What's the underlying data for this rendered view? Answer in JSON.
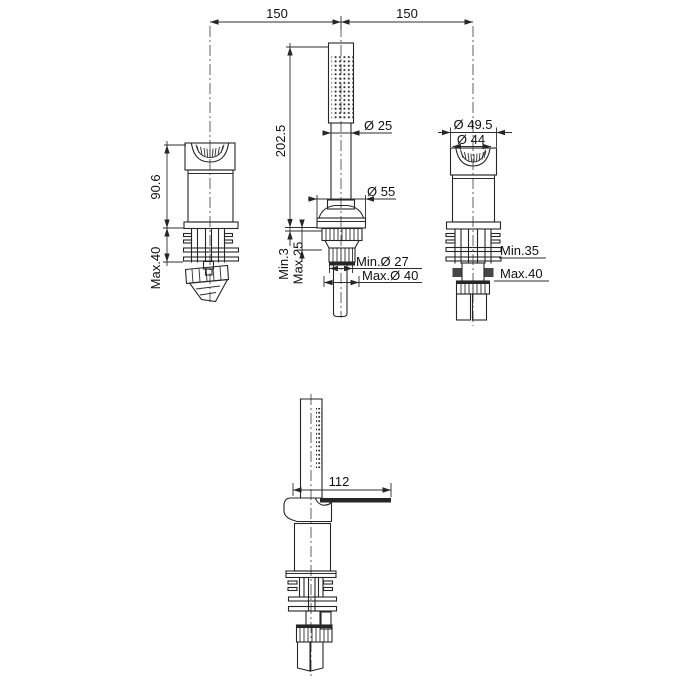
{
  "drawing": {
    "top_view": {
      "span_left": "150",
      "span_right": "150",
      "handle": {
        "height": "90.6",
        "below_max": "Max.40"
      },
      "hand_shower": {
        "height": "202.5",
        "deck_min": "Min.3",
        "deck_max": "Max.25",
        "wand_dia": "Ø 25",
        "base_dia": "Ø 55",
        "hole_min_dia": "Min.Ø 27",
        "hole_max_dia": "Max.Ø 40"
      },
      "diverter": {
        "outer_dia": "Ø 49.5",
        "inner_dia": "Ø 44",
        "below_min": "Min.35",
        "below_max": "Max.40"
      }
    },
    "side_view": {
      "spout_reach": "112"
    }
  },
  "colors": {
    "line": "#262626",
    "text": "#111111",
    "background": "#ffffff"
  }
}
